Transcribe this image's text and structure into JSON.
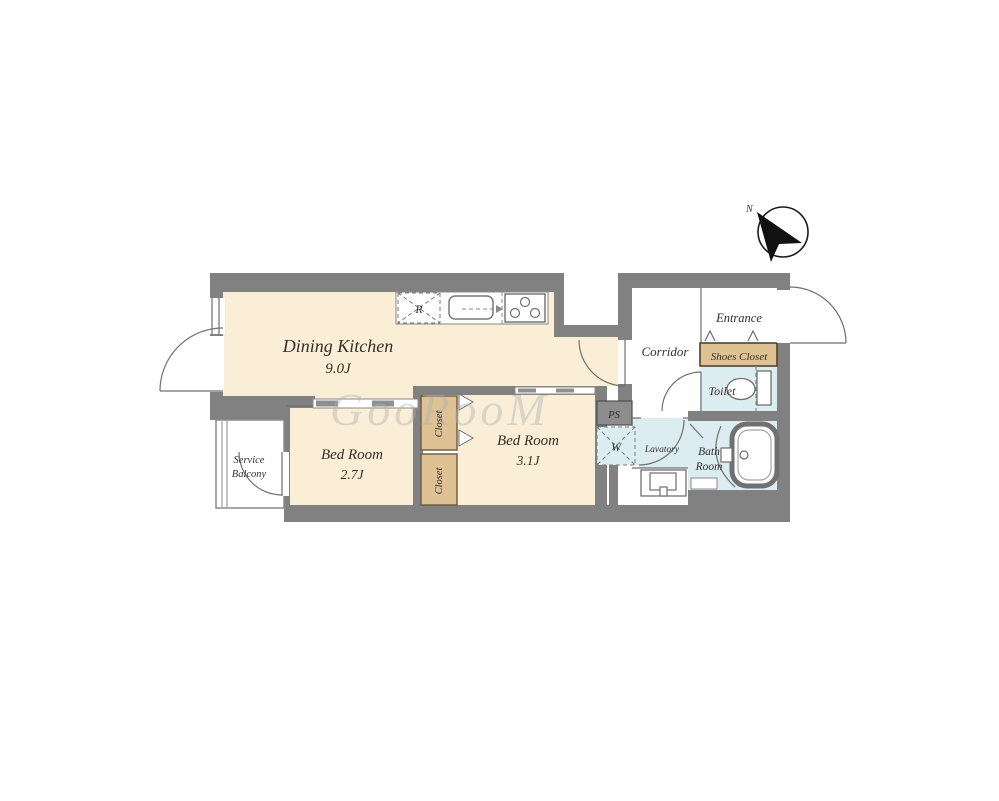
{
  "colors": {
    "wall": "#818181",
    "room_cream": "#fbeed6",
    "closet_tan": "#dfc294",
    "wet_area_blue": "#dcedf1",
    "outline": "#6f6f6f",
    "label_text": "#332f2a",
    "watermark": "#aab2b2"
  },
  "watermark": {
    "text": "GooRooM"
  },
  "compass": {
    "north_label": "N"
  },
  "rooms": {
    "dining_kitchen": {
      "name": "Dining Kitchen",
      "size": "9.0J"
    },
    "bed_room_small": {
      "name": "Bed Room",
      "size": "2.7J"
    },
    "bed_room_large": {
      "name": "Bed Room",
      "size": "3.1J"
    },
    "service_balcony": {
      "line1": "Service",
      "line2": "Balcony"
    },
    "corridor": {
      "name": "Corridor"
    },
    "entrance": {
      "name": "Entrance"
    },
    "shoes_closet": {
      "name": "Shoes Closet"
    },
    "toilet": {
      "name": "Toilet"
    },
    "bath_room": {
      "line1": "Bath",
      "line2": "Room"
    },
    "lavatory": {
      "name": "Lavatory"
    },
    "closet_upper": {
      "name": "Closet"
    },
    "closet_lower": {
      "name": "Closet"
    }
  },
  "fixtures": {
    "refrigerator": {
      "label": "R"
    },
    "washing_machine": {
      "label": "W"
    },
    "pipe_space": {
      "label": "PS"
    }
  }
}
